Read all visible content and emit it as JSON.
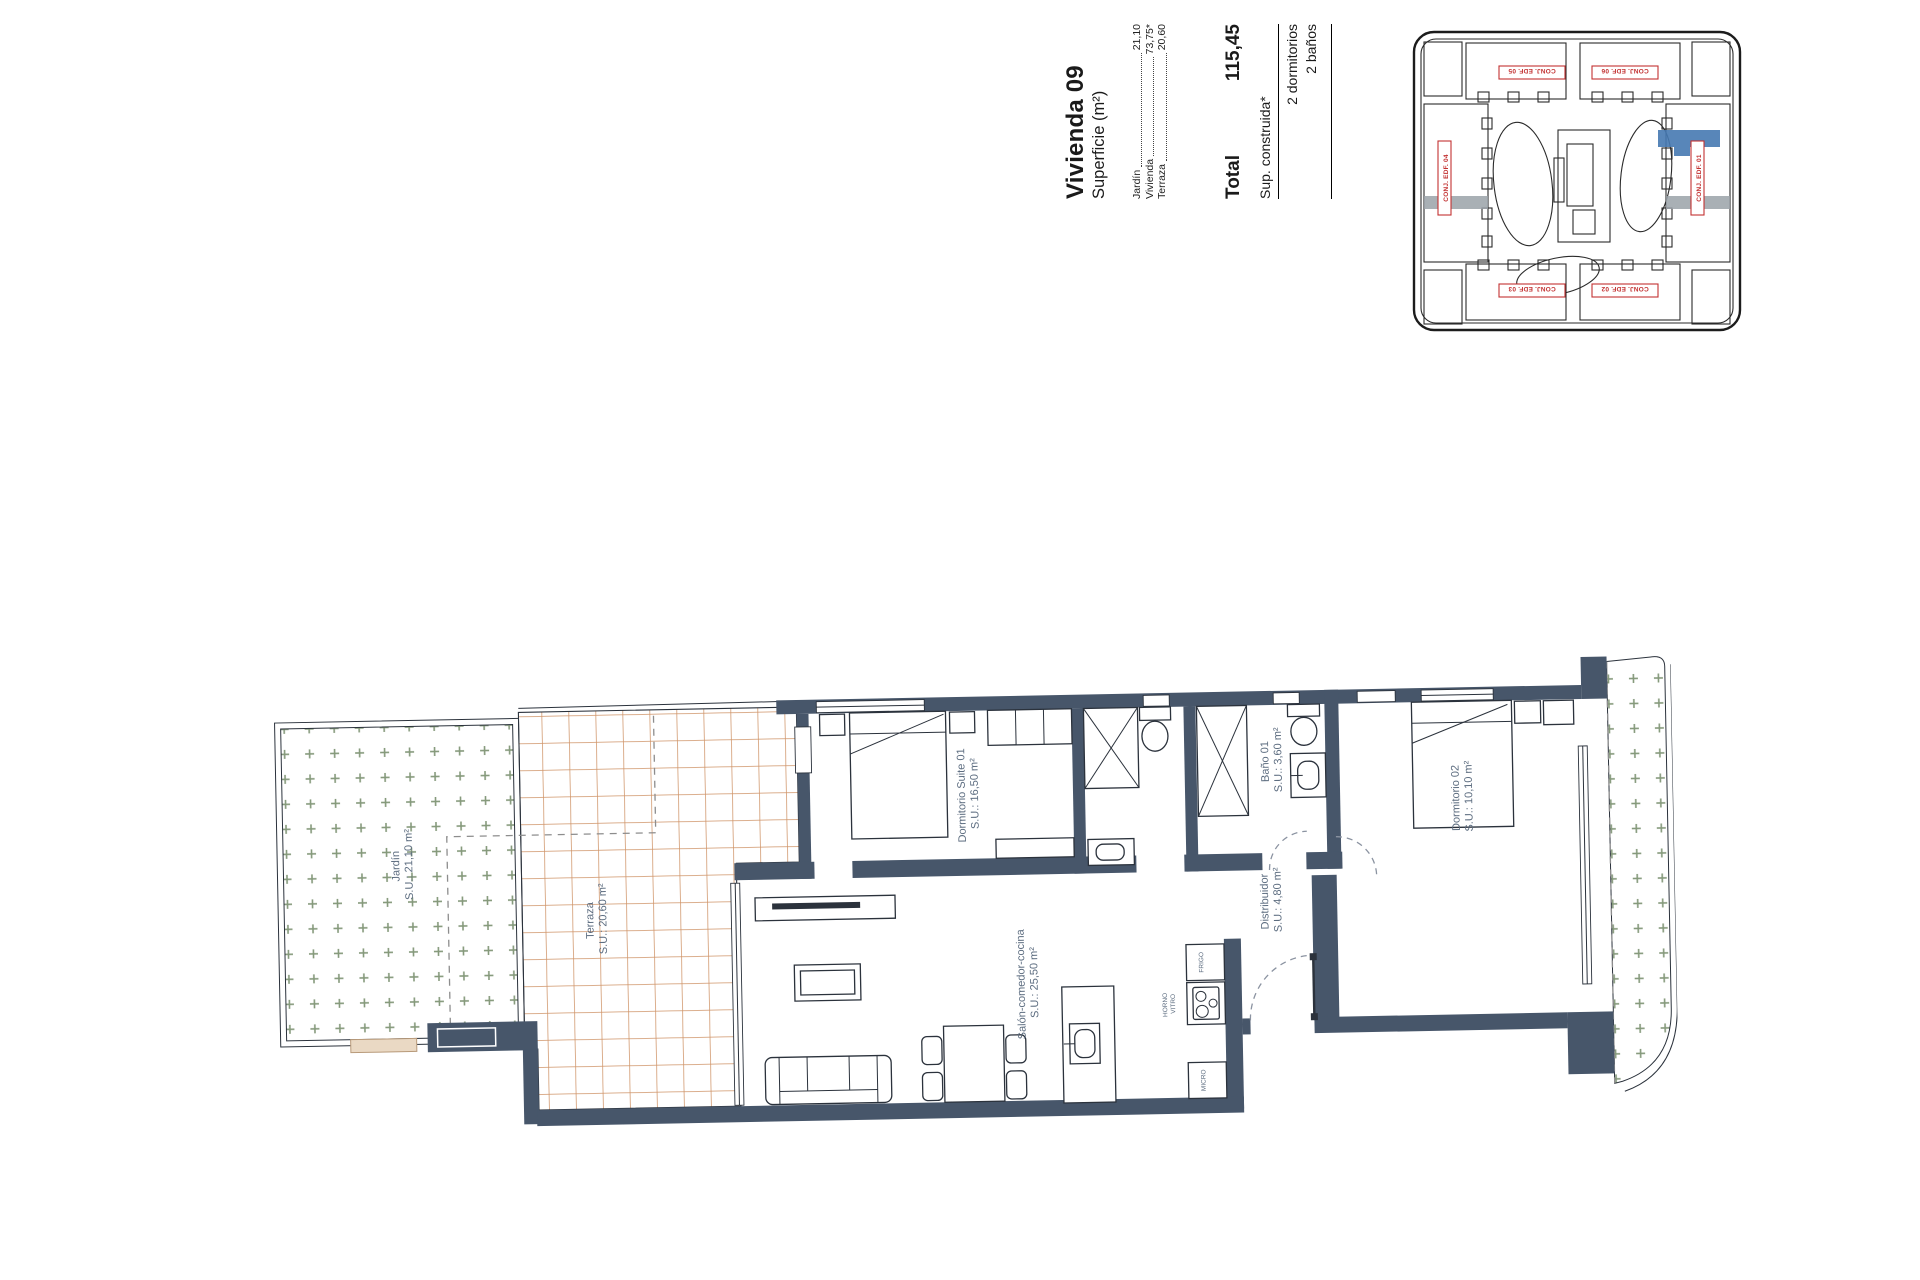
{
  "legend": {
    "title": "Vivienda 09",
    "subtitle": "Superficie (m²)",
    "rows": [
      {
        "label": "Jardín",
        "value": "21,10"
      },
      {
        "label": "Vivienda",
        "value": "73,75*"
      },
      {
        "label": "Terraza",
        "value": "20,60"
      }
    ],
    "total_label": "Total",
    "total_value": "115,45",
    "built_note": "Sup. construida*",
    "features": [
      "2 dormitorios",
      "2 baños"
    ]
  },
  "site_plan": {
    "labels": {
      "top_left": "CONJ. EDF. 05",
      "top_right": "CONJ. EDF. 06",
      "bottom_left": "CONJ. EDF. 03",
      "bottom_right": "CONJ. EDF. 02",
      "left": "CONJ. EDF. 04",
      "right": "CONJ. EDF. 01"
    },
    "highlight_color": "#4679b2"
  },
  "rooms": {
    "jardin": {
      "name": "Jardín",
      "area": "S.U.: 21,10 m²"
    },
    "terraza": {
      "name": "Terraza",
      "area": "S.U.: 20,60 m²"
    },
    "suite": {
      "name": "Dormitorio Suite 01",
      "area": "S.U.: 16,50 m²"
    },
    "bano1": {
      "name": "Baño 01",
      "area": "S.U.: 3,60 m²"
    },
    "distribuidor": {
      "name": "Distribuidor",
      "area": "S.U.: 4,80 m²"
    },
    "dorm2": {
      "name": "Dormitorio 02",
      "area": "S.U.: 10,10 m²"
    },
    "salon": {
      "name": "Salón-comedor-cocina",
      "area": "S.U.: 25,50 m²"
    }
  },
  "kitchen": {
    "fridge": "FRIGO",
    "oven_line1": "HORNO",
    "oven_line2": "VITRO",
    "micro": "MICRO"
  },
  "colors": {
    "wall": "#47566a",
    "tile_line": "#cf9468",
    "garden_cross": "#85997b",
    "label": "#5d6d80",
    "site_label_red": "#c23131",
    "highlight_blue": "#4679b2"
  }
}
